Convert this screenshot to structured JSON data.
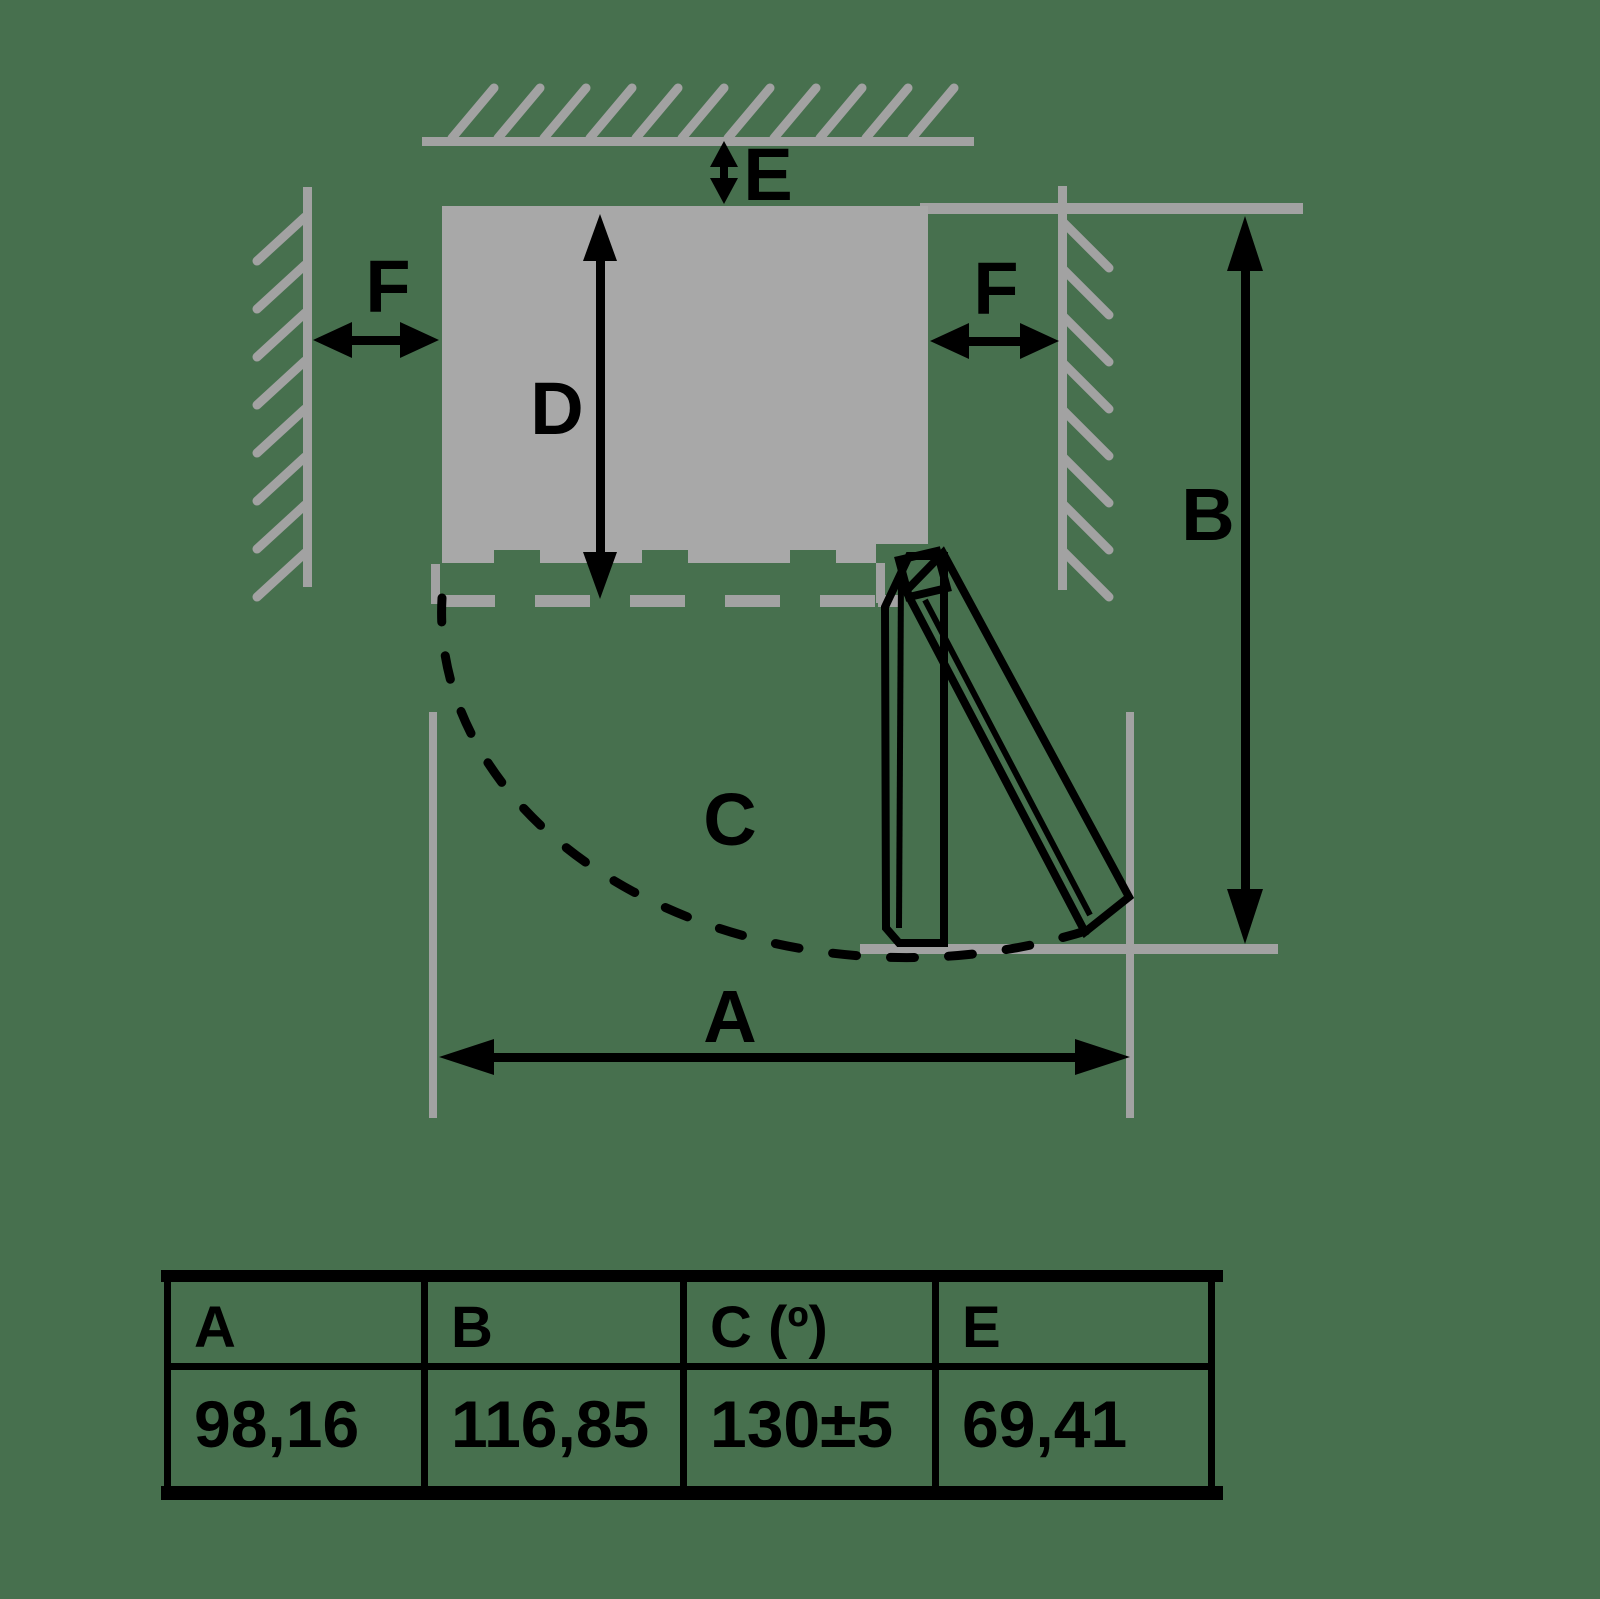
{
  "colors": {
    "background": "#47704e",
    "wall_gray": "#a2a2a2",
    "appliance_gray": "#a8a8a8",
    "ink": "#000000"
  },
  "diagram": {
    "labels": {
      "top_gap": "E",
      "left_gap": "F",
      "right_gap": "F",
      "depth": "D",
      "height": "B",
      "swing": "C",
      "width": "A"
    }
  },
  "table": {
    "headers": [
      "A",
      "B",
      "C (º)",
      "E"
    ],
    "values": [
      "98,16",
      "116,85",
      "130±5",
      "69,41"
    ]
  }
}
